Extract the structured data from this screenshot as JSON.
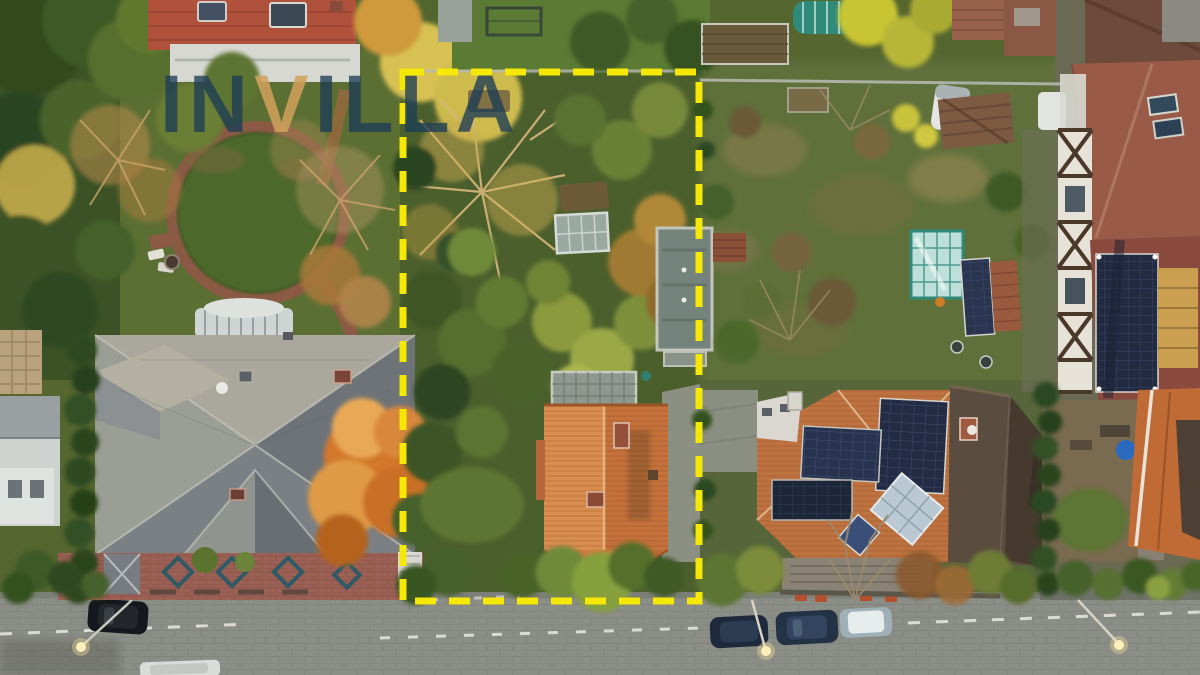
{
  "watermark": {
    "full_text": "INVILLA",
    "segments": [
      {
        "text": "IN",
        "role": "brand-navy"
      },
      {
        "text": "V",
        "role": "brand-accent"
      },
      {
        "text": "ILLA",
        "role": "brand-navy"
      }
    ],
    "color": "#1c3c56",
    "accent_color": "#ce9f5a"
  },
  "plot_boundary": {
    "color": "#f5e804",
    "style": "dashed"
  },
  "palette": {
    "garden_green": "#55662f",
    "lawn_green": "#4c682b",
    "road_gray": "#8b8e86",
    "plot_house_roof_orange": "#cf7b40",
    "mansion_roof_gray": "#8a8e91",
    "solar_panel_navy": "#232c44",
    "greenhouse_teal": "#2f8a7a",
    "autumn_orange": "#d3782c",
    "autumn_gold": "#cdbb4e"
  }
}
